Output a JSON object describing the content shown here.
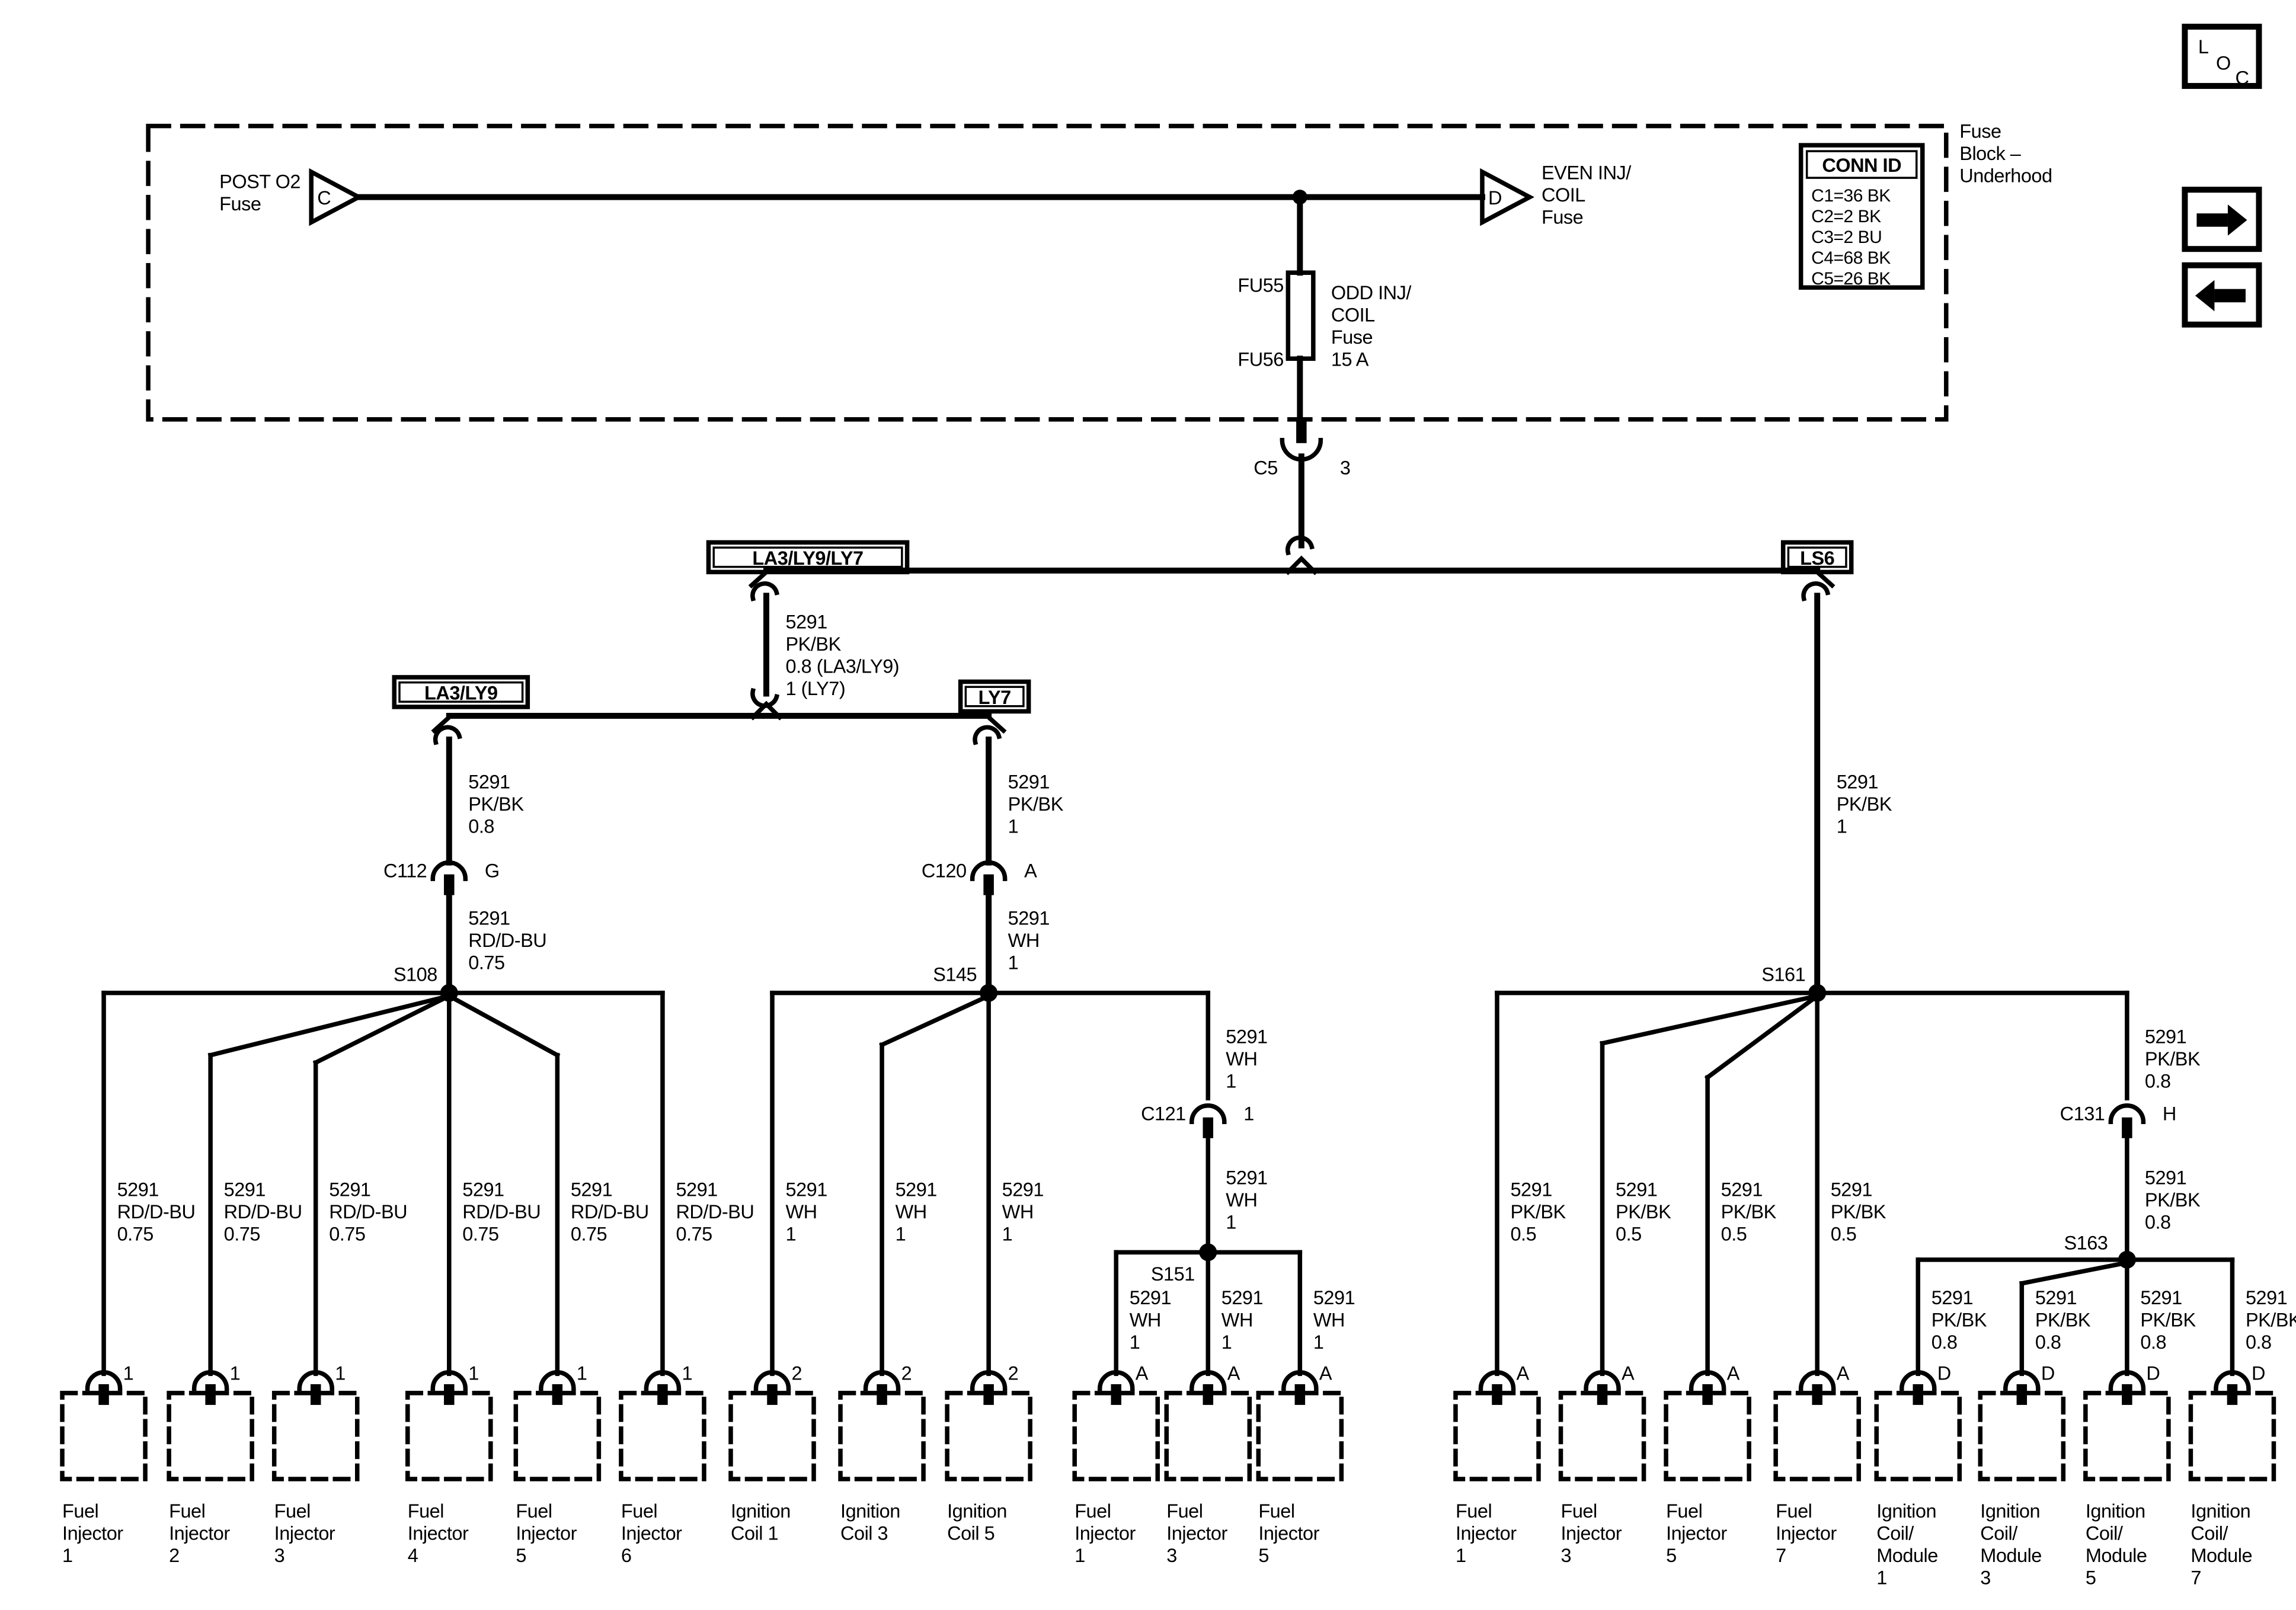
{
  "colors": {
    "ink": "#000000",
    "paper": "#ffffff"
  },
  "nav": {
    "loc": [
      "L",
      "O",
      "C"
    ]
  },
  "titles": {
    "fuse_block": [
      "Fuse",
      "Block –",
      "Underhood"
    ]
  },
  "power": {
    "post_o2": {
      "lines": [
        "POST O2",
        "Fuse"
      ],
      "pin": "C"
    },
    "even_inj": {
      "lines": [
        "EVEN INJ/",
        "COIL",
        "Fuse"
      ],
      "pin": "D"
    },
    "odd_fuse": {
      "id_top": "FU55",
      "id_bottom": "FU56",
      "lines": [
        "ODD INJ/",
        "COIL",
        "Fuse",
        "15 A"
      ]
    },
    "conn_id": {
      "title": "CONN ID",
      "rows": [
        "C1=36 BK",
        "C2=2 BK",
        "C3=2 BU",
        "C4=68 BK",
        "C5=26 BK"
      ]
    }
  },
  "harness_tags": {
    "main": "LA3/LY9/LY7",
    "left": "LA3/LY9",
    "mid": "LY7",
    "right": "LS6"
  },
  "inline_connectors": {
    "c5": {
      "name": "C5",
      "pin": "3"
    },
    "c112": {
      "name": "C112",
      "pin": "G"
    },
    "c120": {
      "name": "C120",
      "pin": "A"
    },
    "c121": {
      "name": "C121",
      "pin": "1"
    },
    "c131": {
      "name": "C131",
      "pin": "H"
    }
  },
  "splices": {
    "s108": "S108",
    "s145": "S145",
    "s151": "S151",
    "s161": "S161",
    "s163": "S163"
  },
  "wire_labels": {
    "main_feed": [
      "5291",
      "PK/BK",
      "0.8 (LA3/LY9)",
      "1 (LY7)"
    ],
    "la3ly9_upper": [
      "5291",
      "PK/BK",
      "0.8"
    ],
    "la3ly9_lower": [
      "5291",
      "RD/D-BU",
      "0.75"
    ],
    "ly7_upper": [
      "5291",
      "PK/BK",
      "1"
    ],
    "ly7_lower": [
      "5291",
      "WH",
      "1"
    ],
    "ls6": [
      "5291",
      "PK/BK",
      "1"
    ],
    "c121_upper": [
      "5291",
      "WH",
      "1"
    ],
    "c121_lower": [
      "5291",
      "WH",
      "1"
    ],
    "c131_upper": [
      "5291",
      "PK/BK",
      "0.8"
    ],
    "c131_lower": [
      "5291",
      "PK/BK",
      "0.8"
    ]
  },
  "drops": [
    {
      "pin": "1",
      "wire": [
        "5291",
        "RD/D-BU",
        "0.75"
      ],
      "component": [
        "Fuel",
        "Injector",
        "1"
      ]
    },
    {
      "pin": "1",
      "wire": [
        "5291",
        "RD/D-BU",
        "0.75"
      ],
      "component": [
        "Fuel",
        "Injector",
        "2"
      ]
    },
    {
      "pin": "1",
      "wire": [
        "5291",
        "RD/D-BU",
        "0.75"
      ],
      "component": [
        "Fuel",
        "Injector",
        "3"
      ]
    },
    {
      "pin": "1",
      "wire": [
        "5291",
        "RD/D-BU",
        "0.75"
      ],
      "component": [
        "Fuel",
        "Injector",
        "4"
      ]
    },
    {
      "pin": "1",
      "wire": [
        "5291",
        "RD/D-BU",
        "0.75"
      ],
      "component": [
        "Fuel",
        "Injector",
        "5"
      ]
    },
    {
      "pin": "1",
      "wire": [
        "5291",
        "RD/D-BU",
        "0.75"
      ],
      "component": [
        "Fuel",
        "Injector",
        "6"
      ]
    },
    {
      "pin": "2",
      "wire": [
        "5291",
        "WH",
        "1"
      ],
      "component": [
        "Ignition",
        "Coil 1"
      ]
    },
    {
      "pin": "2",
      "wire": [
        "5291",
        "WH",
        "1"
      ],
      "component": [
        "Ignition",
        "Coil 3"
      ]
    },
    {
      "pin": "2",
      "wire": [
        "5291",
        "WH",
        "1"
      ],
      "component": [
        "Ignition",
        "Coil 5"
      ]
    },
    {
      "pin": "A",
      "wire": [
        "5291",
        "WH",
        "1"
      ],
      "component": [
        "Fuel",
        "Injector",
        "1"
      ]
    },
    {
      "pin": "A",
      "wire": [
        "5291",
        "WH",
        "1"
      ],
      "component": [
        "Fuel",
        "Injector",
        "3"
      ]
    },
    {
      "pin": "A",
      "wire": [
        "5291",
        "WH",
        "1"
      ],
      "component": [
        "Fuel",
        "Injector",
        "5"
      ]
    },
    {
      "pin": "A",
      "wire": [
        "5291",
        "PK/BK",
        "0.5"
      ],
      "component": [
        "Fuel",
        "Injector",
        "1"
      ]
    },
    {
      "pin": "A",
      "wire": [
        "5291",
        "PK/BK",
        "0.5"
      ],
      "component": [
        "Fuel",
        "Injector",
        "3"
      ]
    },
    {
      "pin": "A",
      "wire": [
        "5291",
        "PK/BK",
        "0.5"
      ],
      "component": [
        "Fuel",
        "Injector",
        "5"
      ]
    },
    {
      "pin": "A",
      "wire": [
        "5291",
        "PK/BK",
        "0.5"
      ],
      "component": [
        "Fuel",
        "Injector",
        "7"
      ]
    },
    {
      "pin": "D",
      "wire": [
        "5291",
        "PK/BK",
        "0.8"
      ],
      "component": [
        "Ignition",
        "Coil/",
        "Module",
        "1"
      ]
    },
    {
      "pin": "D",
      "wire": [
        "5291",
        "PK/BK",
        "0.8"
      ],
      "component": [
        "Ignition",
        "Coil/",
        "Module",
        "3"
      ]
    },
    {
      "pin": "D",
      "wire": [
        "5291",
        "PK/BK",
        "0.8"
      ],
      "component": [
        "Ignition",
        "Coil/",
        "Module",
        "5"
      ]
    },
    {
      "pin": "D",
      "wire": [
        "5291",
        "PK/BK",
        "0.8"
      ],
      "component": [
        "Ignition",
        "Coil/",
        "Module",
        "7"
      ]
    }
  ]
}
